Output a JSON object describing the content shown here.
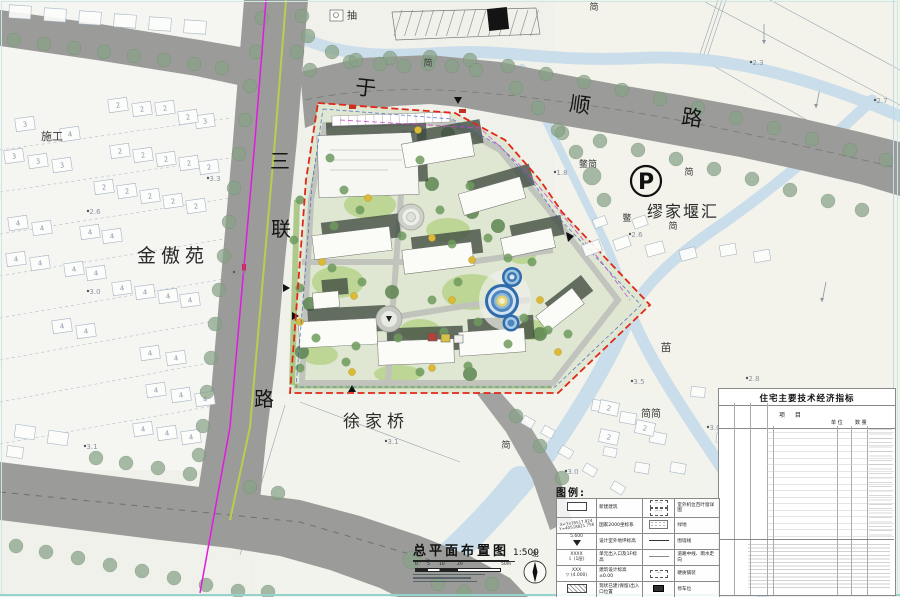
{
  "map": {
    "road_top": {
      "chars": [
        "于",
        "顺",
        "路"
      ]
    },
    "road_left": {
      "chars": [
        "三",
        "联",
        "路"
      ]
    },
    "area_labels": {
      "jinaoyuan": "金傲苑",
      "miujiayanhui": "缪家堰汇",
      "xujiaqiao": "徐家桥",
      "shigong": "施工",
      "miao": "苗",
      "jianjian": "简简",
      "parking_symbol": "P"
    },
    "small_labels": {
      "chou": "抽",
      "jian_a": "简",
      "jian_b": "简",
      "biejian": "鳖简",
      "jian_c": "简",
      "bie": "鳖",
      "jian_d": "简",
      "jian_e": "简"
    },
    "elevations": [
      "2.6",
      "3.0",
      "3.3",
      "2.9",
      "3.1",
      "3.1",
      "1.8",
      "2.6",
      "2.7",
      "2.3",
      "2.8",
      "3.5",
      "3.0",
      "3.0"
    ],
    "houses": [
      {
        "x": 25,
        "y": 124,
        "n": "3"
      },
      {
        "x": 14,
        "y": 156,
        "n": "3"
      },
      {
        "x": 38,
        "y": 161,
        "n": "3"
      },
      {
        "x": 62,
        "y": 165,
        "n": "3"
      },
      {
        "x": 205,
        "y": 121,
        "n": "3"
      },
      {
        "x": 70,
        "y": 134,
        "n": "4"
      },
      {
        "x": 118,
        "y": 105,
        "n": "2"
      },
      {
        "x": 142,
        "y": 109,
        "n": "2"
      },
      {
        "x": 165,
        "y": 108,
        "n": "2"
      },
      {
        "x": 188,
        "y": 117,
        "n": "2"
      },
      {
        "x": 120,
        "y": 151,
        "n": "2"
      },
      {
        "x": 143,
        "y": 155,
        "n": "2"
      },
      {
        "x": 166,
        "y": 159,
        "n": "2"
      },
      {
        "x": 189,
        "y": 163,
        "n": "2"
      },
      {
        "x": 209,
        "y": 167,
        "n": "2"
      },
      {
        "x": 104,
        "y": 187,
        "n": "2"
      },
      {
        "x": 127,
        "y": 191,
        "n": "2"
      },
      {
        "x": 150,
        "y": 196,
        "n": "2"
      },
      {
        "x": 173,
        "y": 201,
        "n": "2"
      },
      {
        "x": 196,
        "y": 206,
        "n": "2"
      },
      {
        "x": 18,
        "y": 223,
        "n": "4"
      },
      {
        "x": 42,
        "y": 228,
        "n": "4"
      },
      {
        "x": 90,
        "y": 232,
        "n": "4"
      },
      {
        "x": 112,
        "y": 236,
        "n": "4"
      },
      {
        "x": 16,
        "y": 259,
        "n": "4"
      },
      {
        "x": 40,
        "y": 263,
        "n": "4"
      },
      {
        "x": 74,
        "y": 269,
        "n": "4"
      },
      {
        "x": 96,
        "y": 273,
        "n": "4"
      },
      {
        "x": 122,
        "y": 288,
        "n": "4"
      },
      {
        "x": 145,
        "y": 292,
        "n": "4"
      },
      {
        "x": 168,
        "y": 296,
        "n": "4"
      },
      {
        "x": 190,
        "y": 300,
        "n": "4"
      },
      {
        "x": 62,
        "y": 326,
        "n": "4"
      },
      {
        "x": 86,
        "y": 331,
        "n": "4"
      },
      {
        "x": 150,
        "y": 353,
        "n": "4"
      },
      {
        "x": 176,
        "y": 358,
        "n": "4"
      },
      {
        "x": 156,
        "y": 390,
        "n": "4"
      },
      {
        "x": 181,
        "y": 395,
        "n": "4"
      },
      {
        "x": 205,
        "y": 399,
        "n": "4"
      },
      {
        "x": 143,
        "y": 429,
        "n": "4"
      },
      {
        "x": 167,
        "y": 433,
        "n": "4"
      },
      {
        "x": 191,
        "y": 437,
        "n": "4"
      },
      {
        "x": 609,
        "y": 408,
        "n": "2"
      },
      {
        "x": 645,
        "y": 428,
        "n": "2"
      },
      {
        "x": 609,
        "y": 437,
        "n": "2"
      }
    ]
  },
  "legend": {
    "title": "图例:",
    "coord_line1": "X=3378517.924",
    "coord_line2": "Y=40518821.758",
    "lv1": "5.600",
    "lv2": "XXXX",
    "lv2b": "(1层)",
    "lv3": "XXX",
    "lv3b": "(4.000)",
    "rows_left": [
      "新建建筑",
      "国家2000坐标系",
      "设计室外地坪标高",
      "单元出入口及1F标高",
      "建筑设计标高±0.00",
      "现状已建(保留)出入口位置"
    ],
    "rows_right": [
      "室外机位百叶窗详图",
      "绿地",
      "围墙线",
      "道路中线、雨水走向",
      "硬质铺装",
      "停车位"
    ]
  },
  "table": {
    "title": "住宅主要技术经济指标",
    "h_item": "项 目",
    "h_unit": "单 位",
    "h_qty": "数 量"
  },
  "titleblock": {
    "title": "总平面布置图",
    "scale": "1:500",
    "ticks": [
      "0",
      "5",
      "10",
      "20",
      "50m"
    ],
    "north": "北"
  }
}
